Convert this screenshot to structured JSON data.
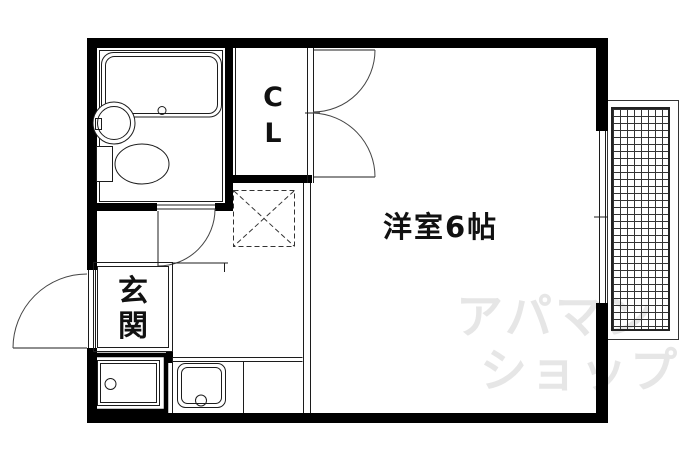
{
  "floorplan": {
    "rooms": {
      "main_room": {
        "label": "洋室6帖"
      },
      "entrance": {
        "label": "玄関"
      },
      "closet": {
        "label": "CL"
      }
    },
    "watermark": {
      "lines": [
        "アパマン",
        "ショップ"
      ]
    },
    "colors": {
      "wall": "#000000",
      "line": "#1c1c1c",
      "watermark": "#e6e6e6",
      "background": "#ffffff"
    }
  }
}
